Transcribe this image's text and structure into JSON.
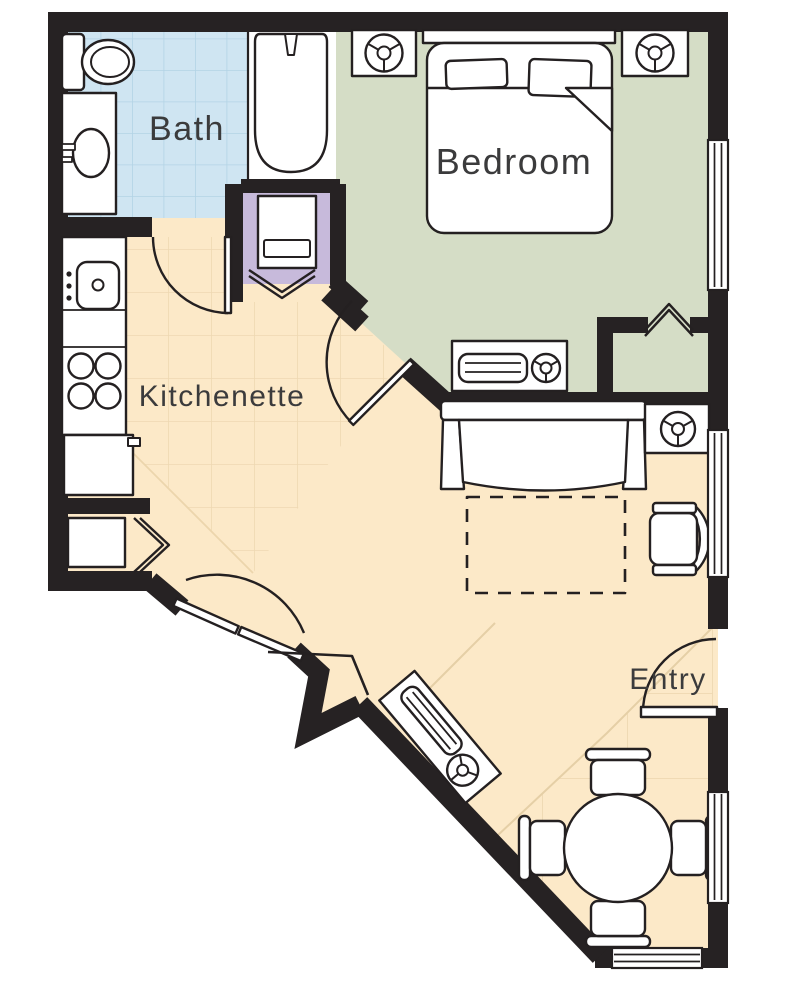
{
  "plan": {
    "title": "Studio suite floor plan",
    "rooms": [
      {
        "id": "bath",
        "label": "Bath"
      },
      {
        "id": "bedroom",
        "label": "Bedroom"
      },
      {
        "id": "kitchenette",
        "label": "Kitchenette"
      },
      {
        "id": "entry",
        "label": "Entry"
      }
    ],
    "fixtures": [
      "toilet",
      "vanity-sink",
      "bathtub",
      "washer-closet",
      "kitchen-sink",
      "stove-burners",
      "refrigerator",
      "closet-shelf",
      "bed",
      "headboard",
      "pillows",
      "nightstand-lamp-left",
      "nightstand-lamp-right",
      "dresser-tv-lamp",
      "sofa",
      "sleeper-footprint",
      "corner-table-lamp",
      "armchair",
      "media-console-lamp",
      "dining-table",
      "dining-chairs",
      "bath-door",
      "bedroom-door",
      "bifold-closet-doors",
      "entry-door",
      "windows"
    ]
  },
  "colors": {
    "wall": "#262223",
    "line": "#242021",
    "fixture_fill": "#ffffff",
    "floor_main": "#fce9c8",
    "floor_bath": "#cfe5f2",
    "floor_bedroom": "#d5ddc6",
    "floor_closet": "#c7badb",
    "tile_line_blue": "#b3d3e5",
    "tile_line_tan": "#eed8b2",
    "tile_edge_tan": "#e5cfa6",
    "label_text": "#3b3b3c"
  }
}
